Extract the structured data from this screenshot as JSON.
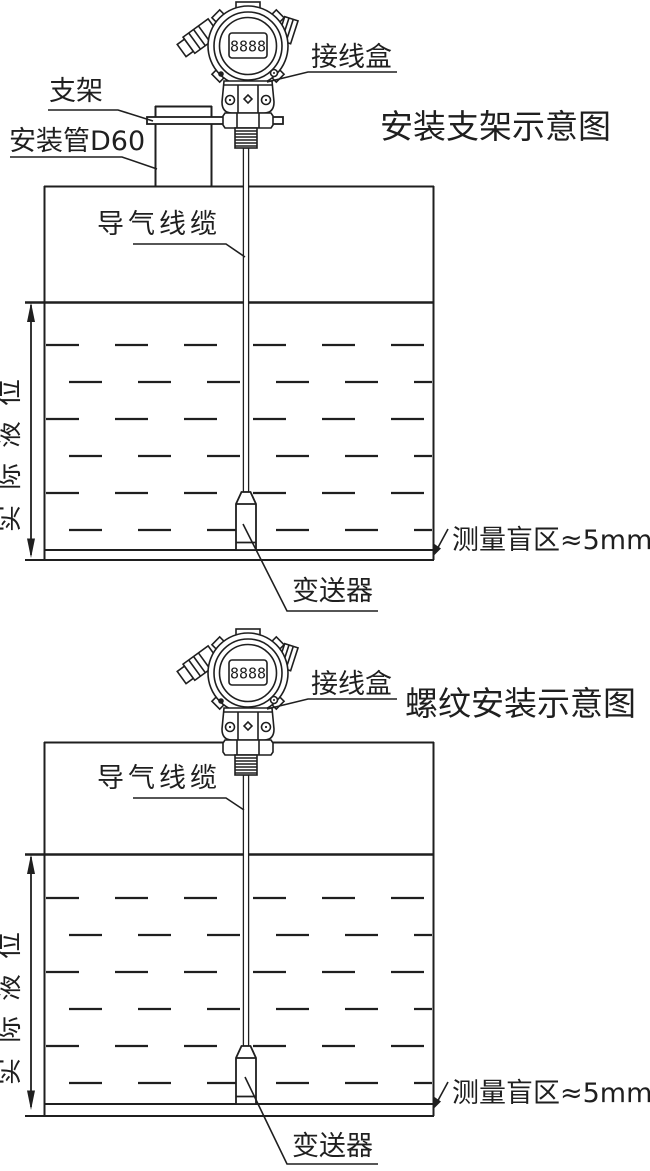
{
  "page": {
    "background_color": "#ffffff",
    "ink_color": "#1f1f1f"
  },
  "device": {
    "display": "8888"
  },
  "top_diagram": {
    "title": "安装支架示意图",
    "labels": {
      "junction_box": "接线盒",
      "bracket": "支架",
      "mounting_pipe": "安装管D60",
      "air_cable": "导气线缆",
      "actual_level": "实际液位",
      "blind_zone": "测量盲区≈5mm",
      "transmitter": "变送器"
    }
  },
  "bottom_diagram": {
    "title": "螺纹安装示意图",
    "labels": {
      "junction_box": "接线盒",
      "air_cable": "导气线缆",
      "actual_level": "实际液位",
      "blind_zone": "测量盲区≈5mm",
      "transmitter": "变送器"
    }
  }
}
